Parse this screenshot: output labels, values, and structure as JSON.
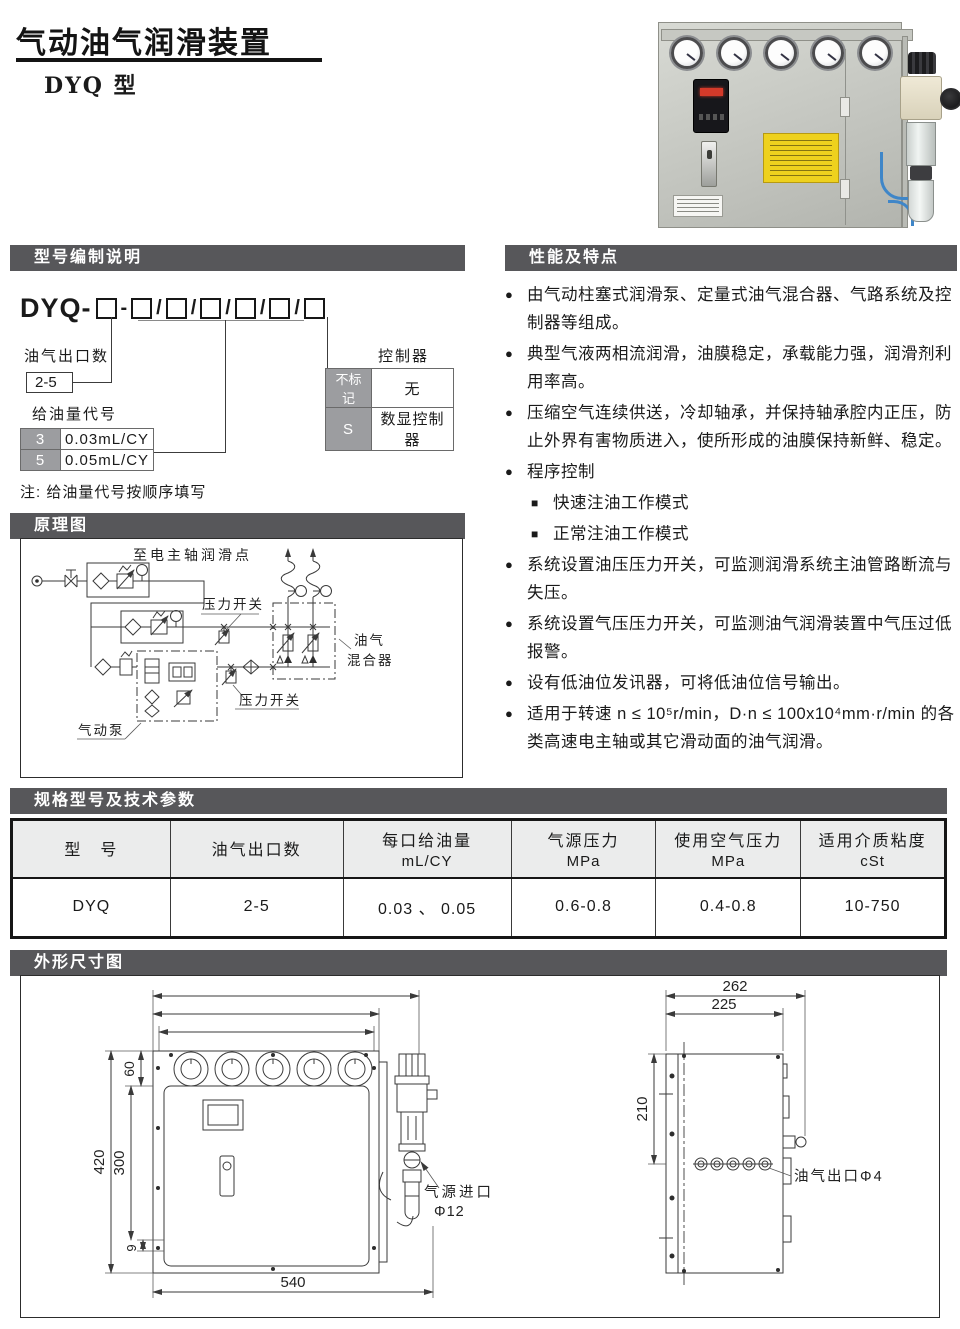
{
  "page": {
    "title": "气动油气润滑装置",
    "subtitle": "DYQ 型"
  },
  "model": {
    "heading": "型号编制说明",
    "prefix": "DYQ-",
    "dash": "-",
    "slash": "/",
    "outlet_label": "油气出口数",
    "outlet_value": "2-5",
    "oil_label": "给油量代号",
    "oil_rows": [
      {
        "code": "3",
        "value": "0.03mL/CY"
      },
      {
        "code": "5",
        "value": "0.05mL/CY"
      }
    ],
    "controller_label": "控制器",
    "controller_rows": [
      {
        "code": "不标记",
        "value": "无"
      },
      {
        "code": "S",
        "value": "数显控制器"
      }
    ],
    "note": "注: 给油量代号按顺序填写"
  },
  "features": {
    "heading": "性能及特点",
    "items": [
      {
        "bullet": "●",
        "text": "由气动柱塞式润滑泵、定量式油气混合器、气路系统及控制器等组成。"
      },
      {
        "bullet": "●",
        "text": "典型气液两相流润滑，油膜稳定，承载能力强，润滑剂利用率高。"
      },
      {
        "bullet": "●",
        "text": "压缩空气连续供送，冷却轴承，并保持轴承腔内正压，防止外界有害物质进入，使所形成的油膜保持新鲜、稳定。"
      },
      {
        "bullet": "●",
        "text": "程序控制"
      },
      {
        "bullet": "■",
        "text": "快速注油工作模式"
      },
      {
        "bullet": "■",
        "text": "正常注油工作模式"
      },
      {
        "bullet": "●",
        "text": "系统设置油压压力开关，可监测润滑系统主油管路断流与失压。"
      },
      {
        "bullet": "●",
        "text": "系统设置气压压力开关，可监测油气润滑装置中气压过低报警。"
      },
      {
        "bullet": "●",
        "text": "设有低油位发讯器，可将低油位信号输出。"
      },
      {
        "bullet": "●",
        "text": "适用于转速 n ≤ 10⁵r/min，D·n ≤ 100x10⁴mm·r/min 的各类高速电主轴或其它滑动面的油气润滑。"
      }
    ]
  },
  "schematic": {
    "heading": "原理图",
    "labels": {
      "to_spindle": "至电主轴润滑点",
      "pressure_switch_top": "压力开关",
      "pressure_switch_bottom": "压力开关",
      "mixer_line1": "油气",
      "mixer_line2": "混合器",
      "pump": "气动泵"
    }
  },
  "specs": {
    "heading": "规格型号及技术参数",
    "headers": [
      {
        "l1": "型　号",
        "l2": ""
      },
      {
        "l1": "油气出口数",
        "l2": ""
      },
      {
        "l1": "每口给油量",
        "l2": "mL/CY"
      },
      {
        "l1": "气源压力",
        "l2": "MPa"
      },
      {
        "l1": "使用空气压力",
        "l2": "MPa"
      },
      {
        "l1": "适用介质粘度",
        "l2": "cSt"
      }
    ],
    "row": [
      "DYQ",
      "2-5",
      "0.03 、 0.05",
      "0.6-0.8",
      "0.4-0.8",
      "10-750"
    ]
  },
  "dimensions": {
    "heading": "外形尺寸图",
    "front": {
      "d515": "515",
      "d440": "440",
      "d422": "422",
      "d60": "60",
      "d420": "420",
      "d300": "300",
      "d9": "9",
      "d540": "540",
      "inlet_label": "气源进口",
      "inlet_dia": "Φ12"
    },
    "side": {
      "d262": "262",
      "d225": "225",
      "d210": "210",
      "outlet_label": "油气出口Φ4"
    }
  }
}
